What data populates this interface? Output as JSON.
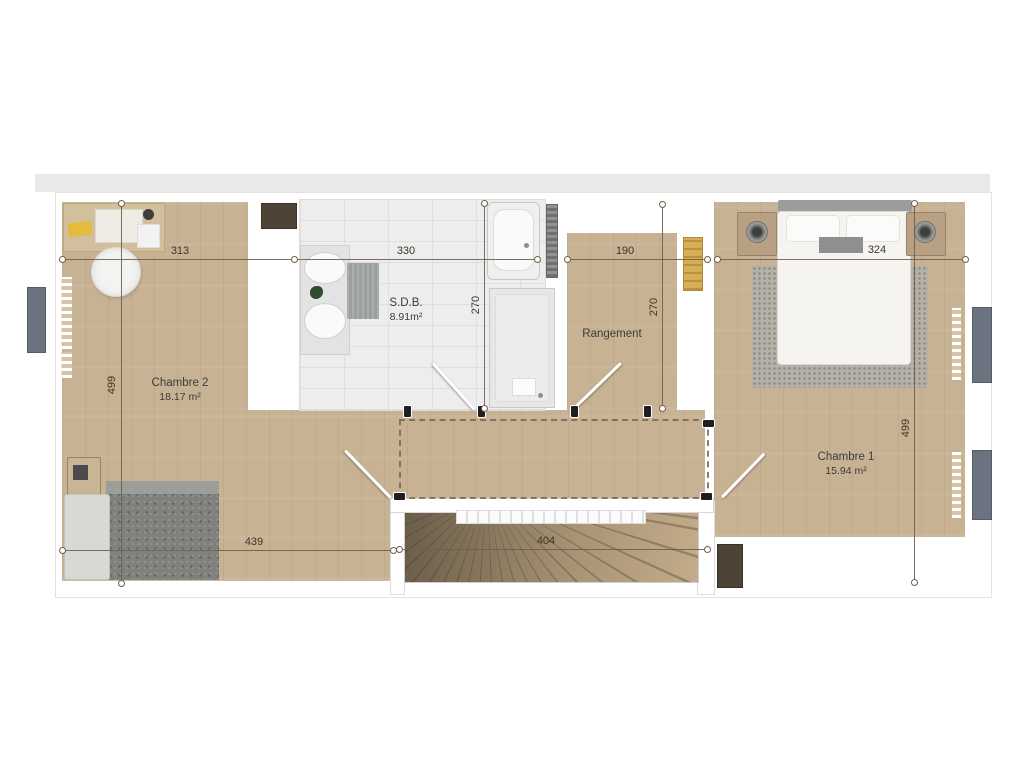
{
  "rooms": {
    "chambre2": {
      "name": "Chambre 2",
      "area": "18.17 m²"
    },
    "sdb": {
      "name": "S.D.B.",
      "area": "8.91m²"
    },
    "rangement": {
      "name": "Rangement"
    },
    "chambre1": {
      "name": "Chambre 1",
      "area": "15.94 m²"
    }
  },
  "dimensions": {
    "chambre2_width": "313",
    "sdb_width": "330",
    "rangement_width": "190",
    "chambre1_width": "324",
    "left_depth": "499",
    "sdb_depth": "270",
    "rangement_depth": "270",
    "right_depth": "499",
    "chambre2_lower_width": "439",
    "stairs_width": "404"
  },
  "colors": {
    "wood_floor": "#c8b294",
    "tile_floor": "#ededed",
    "dimension_line": "#6f5e4b",
    "window_gray": "#6b7280",
    "ladder_yellow": "#d6ae54",
    "chimney_brown": "#4e4337"
  }
}
